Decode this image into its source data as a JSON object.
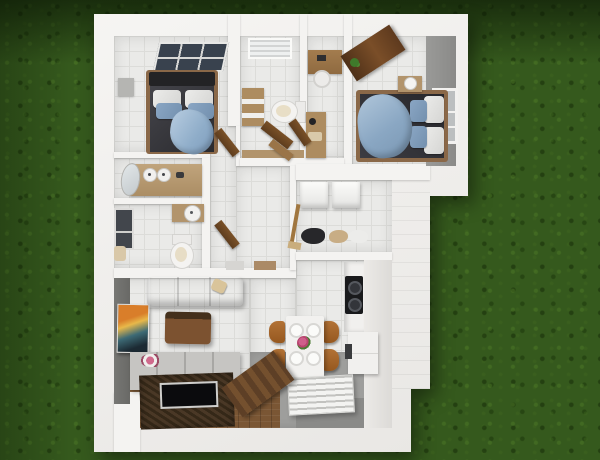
{
  "scene": {
    "type": "3d-floor-plan-top-down-render",
    "setting": "grass lawn backdrop",
    "palette": {
      "grass": "#35591d",
      "grass_shadow": "#16280c",
      "outer_wall": "#f1f0ee",
      "floor_tile": "#eaeae8",
      "accent_wall_gray": "#6e6e6b",
      "wood": "#8a6038",
      "walnut_door": "#5e3d1e",
      "sofa_blue": "#8ba3bf",
      "duvet_dark": "#2e2e33",
      "dining_floor_gray": "#9e9e9c",
      "chair_wood": "#a96a31",
      "flower_pink": "#c2497a"
    }
  },
  "rooms": [
    {
      "id": "bedroom-1",
      "label": "Bedroom 1 (dark double bed, skylight window, blue throw)"
    },
    {
      "id": "bathroom",
      "label": "Bathroom (window blinds, ladder shelf, toilet)"
    },
    {
      "id": "study-nook",
      "label": "Study nook (desk, stool, storage shelf)"
    },
    {
      "id": "bedroom-2",
      "label": "Bedroom 2 (double bed, denim throw, window, open door)"
    },
    {
      "id": "vanity-room",
      "label": "Vanity room (double-sink wood counter, oval mirror)"
    },
    {
      "id": "wc",
      "label": "WC (toilet, wall clock shelf, side window)"
    },
    {
      "id": "hallway",
      "label": "Hallway (open wooden doors, doormats)"
    },
    {
      "id": "laundry",
      "label": "Laundry room (two machines, clothes piles, broom)"
    },
    {
      "id": "kitchen",
      "label": "Kitchen (counter, black cooktop, base cabinet)"
    },
    {
      "id": "dining",
      "label": "Dining area (white table, four wooden chairs, plates, flowers, slatted mat)"
    },
    {
      "id": "living-room",
      "label": "Living room (blue sofa, coffee table, TV sideboard, woven rug, flat TV, wall art, open door)"
    }
  ]
}
